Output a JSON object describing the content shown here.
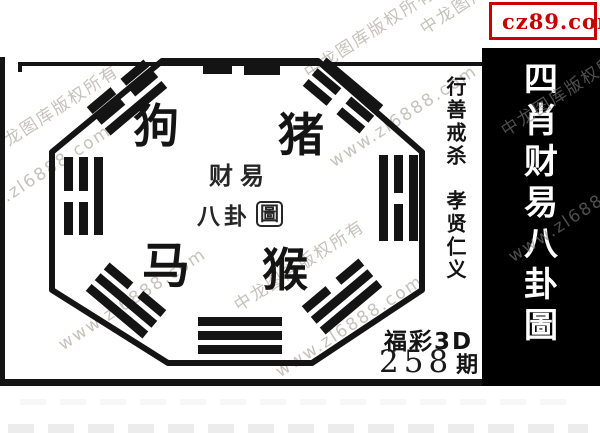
{
  "badge": {
    "label": "cz89.com"
  },
  "panel": {
    "title": "四肖财易八卦圖",
    "chars": [
      "四",
      "肖",
      "财",
      "易",
      "八",
      "卦",
      "圖"
    ]
  },
  "diagram": {
    "animals": {
      "dog": "狗",
      "pig": "猪",
      "horse": "马",
      "monkey": "猴"
    },
    "seal": {
      "line1": "财易",
      "line2": "八卦",
      "boxed": "圖"
    }
  },
  "motto": {
    "line1": "行善戒杀",
    "line2": "孝贤仁义"
  },
  "issue": {
    "lottery": "福彩3D",
    "number": "258",
    "suffix": "期"
  },
  "watermark": {
    "owner": "中龙图库版权所有",
    "site": "www.zl6888.com"
  },
  "colors": {
    "accent_red": "#cc0000",
    "badge_yellow": "#ffe400",
    "panel_bg": "#000000",
    "ink": "#141414"
  }
}
